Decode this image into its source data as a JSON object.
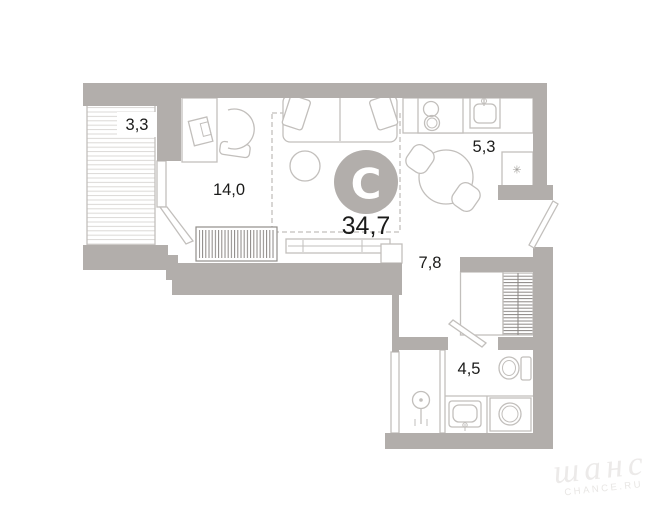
{
  "rooms": {
    "balcony": "3,3",
    "living": "14,0",
    "total": "34,7",
    "kitchen": "5,3",
    "hall": "7,8",
    "bathroom": "4,5"
  },
  "logo": {
    "letter": "C"
  },
  "icons": {
    "fridge_snowflake": "✳"
  },
  "watermark": {
    "script": "шанс",
    "caption": "CHANCE.RU"
  },
  "colors": {
    "wall": "#b2aeab",
    "furniture_line": "#c2bfbc",
    "hatch_dark": "#8a8683",
    "balcony_hatch": "#dbd9d6",
    "label_text": "#1b1b1a",
    "logo_bg": "#b2aeab",
    "logo_letter": "#ffffff",
    "watermark": "#eceae9"
  }
}
